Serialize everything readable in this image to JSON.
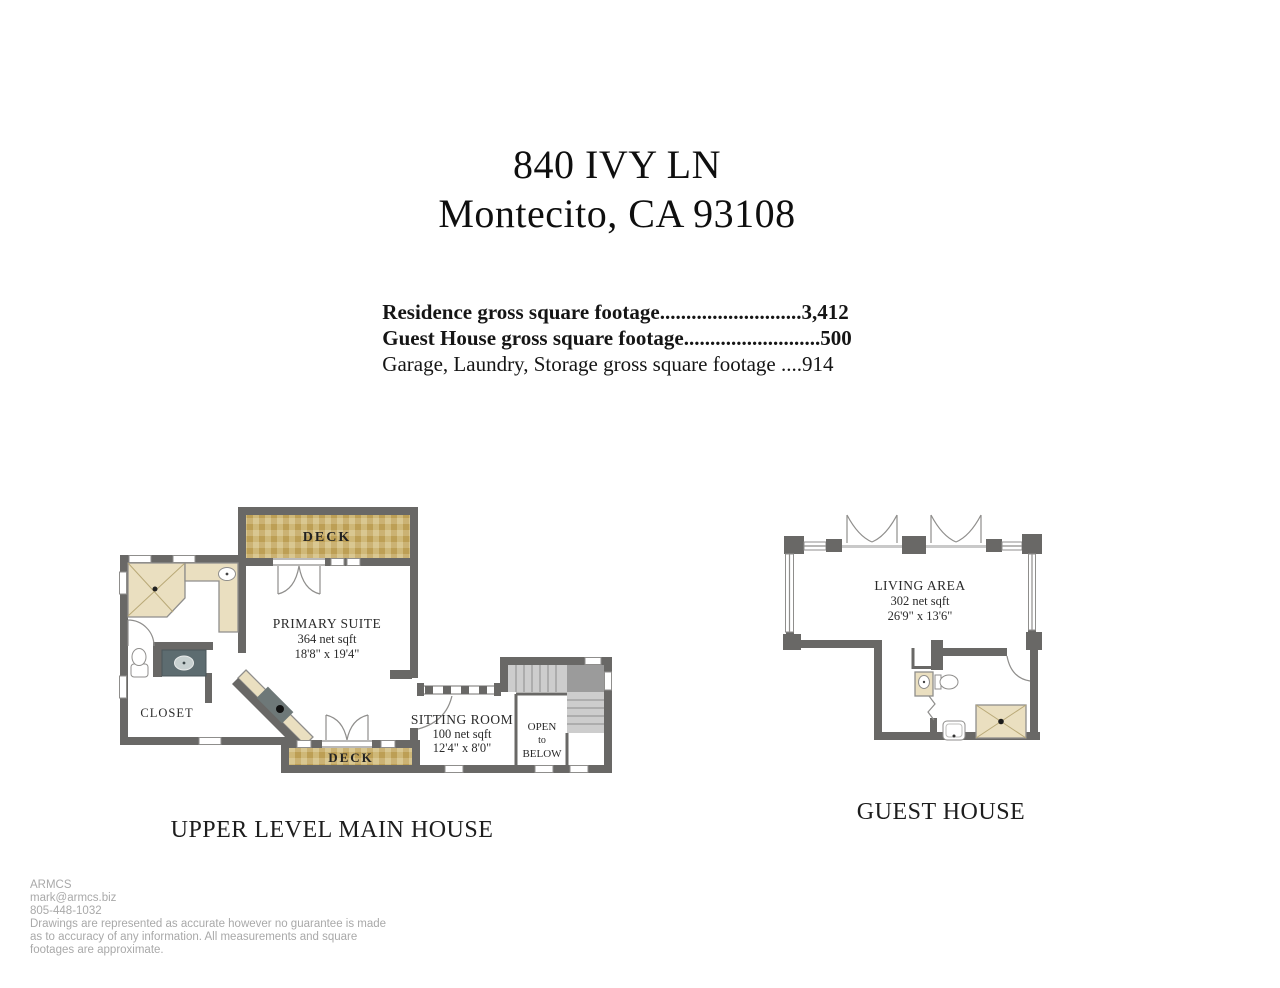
{
  "title": {
    "line1": "840 IVY LN",
    "line2": "Montecito, CA 93108"
  },
  "summary": {
    "line1": "Residence gross square footage...........................3,412",
    "line2": "Guest House gross square footage..........................500",
    "line3": "Garage, Laundry, Storage gross square footage ....914"
  },
  "main_house": {
    "caption": "UPPER LEVEL MAIN HOUSE",
    "deck_top_label": "DECK",
    "deck_bottom_label": "DECK",
    "primary_suite": {
      "name": "PRIMARY SUITE",
      "area": "364 net sqft",
      "dims": "18'8\" x 19'4\""
    },
    "closet_label": "CLOSET",
    "sitting_room": {
      "name": "SITTING ROOM",
      "area": "100 net sqft",
      "dims": "12'4\" x 8'0\""
    },
    "open_below": {
      "l1": "OPEN",
      "l2": "to",
      "l3": "BELOW"
    }
  },
  "guest_house": {
    "caption": "GUEST HOUSE",
    "living_area": {
      "name": "LIVING AREA",
      "area": "302 net sqft",
      "dims": "26'9\" x 13'6\""
    }
  },
  "footer": {
    "company": "ARMCS",
    "email": "mark@armcs.biz",
    "phone": "805-448-1032",
    "disclaimer1": "Drawings are represented as accurate however no guarantee is made",
    "disclaimer2": "as to accuracy of any information. All measurements and square",
    "disclaimer3": "footages are approximate."
  },
  "colors": {
    "wall": "#696866",
    "deck_tile_base": "#cbb273",
    "deck_tile_dark": "#bd9f55",
    "deck_tile_light": "#d9c791",
    "fixture_tan": "#eadfc0",
    "vanity_slate": "#5d6c70",
    "stair_gray": "#cdcdcd",
    "footer_gray": "#a9a9a9",
    "text_dark": "#111111"
  }
}
